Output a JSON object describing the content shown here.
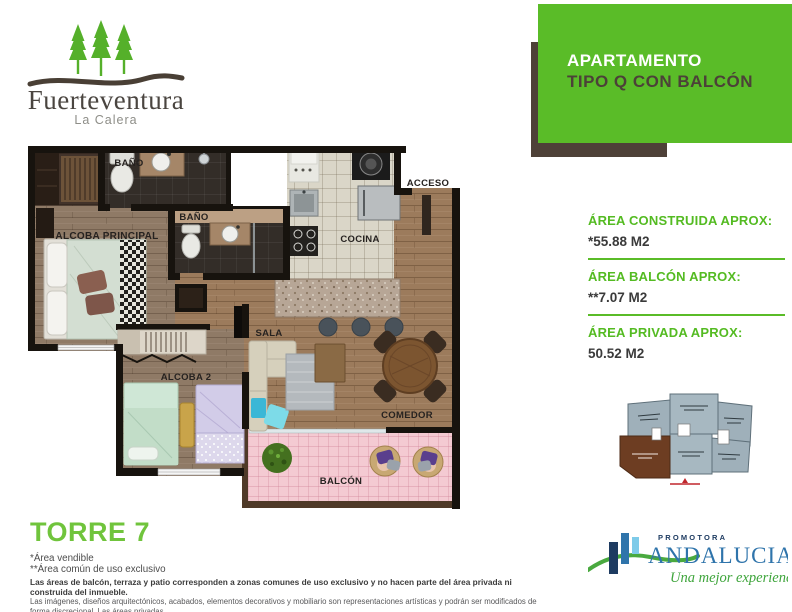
{
  "brand": {
    "name": "Fuerteventura",
    "location": "La Calera"
  },
  "banner": {
    "title_line1": "APARTAMENTO",
    "title_line2": "TIPO Q CON BALCÓN"
  },
  "floor_plan": {
    "rooms": {
      "bano1": "BAÑO",
      "bano2": "BAÑO",
      "acceso": "ACCESO",
      "cocina": "COCINA",
      "alcoba_principal": "ALCOBA PRINCIPAL",
      "sala": "SALA",
      "alcoba2": "ALCOBA 2",
      "comedor": "COMEDOR",
      "balcon": "BALCÓN"
    }
  },
  "areas": [
    {
      "label": "ÁREA CONSTRUIDA APROX:",
      "value": "*55.88 M2"
    },
    {
      "label": "ÁREA BALCÓN APROX:",
      "value": "**7.07 M2"
    },
    {
      "label": "ÁREA PRIVADA APROX:",
      "value": "50.52 M2"
    }
  ],
  "tower_label": "TORRE 7",
  "footnotes": {
    "note1": "*Área vendible",
    "note2": "**Área común de uso exclusivo",
    "disclaimer_bold": "Las áreas de balcón, terraza y patio corresponden a zonas comunes de uso exclusivo y no hacen parte del área privada ni construida del inmueble.",
    "disclaimer_small_1": "Las imágenes, diseños arquitectónicos, acabados, elementos decorativos y mobiliario son representaciones artísticas y podrán ser modificados de forma discrecional. Las áreas privadas",
    "disclaimer_small_2": "y construidas pueden sufrir modificaciones debido a ajustes técnicos y/o procesos constructivos (aprobados por las autoridades competentes: Curaduría o Planeación Municipal)."
  },
  "promoter": {
    "top": "PROMOTORA",
    "name": "ANDALUCIA",
    "tagline": "Una mejor experiencia!"
  },
  "colors": {
    "accent_green": "#5abc28",
    "banner_brown": "#4e4138",
    "torre_green": "#70c43c",
    "balcony_pink": "#f4cad2",
    "keyplan_gray": "#9fb0ba",
    "keyplan_highlight_brown": "#6d3d22",
    "promoter_blue": "#2f74ab"
  }
}
